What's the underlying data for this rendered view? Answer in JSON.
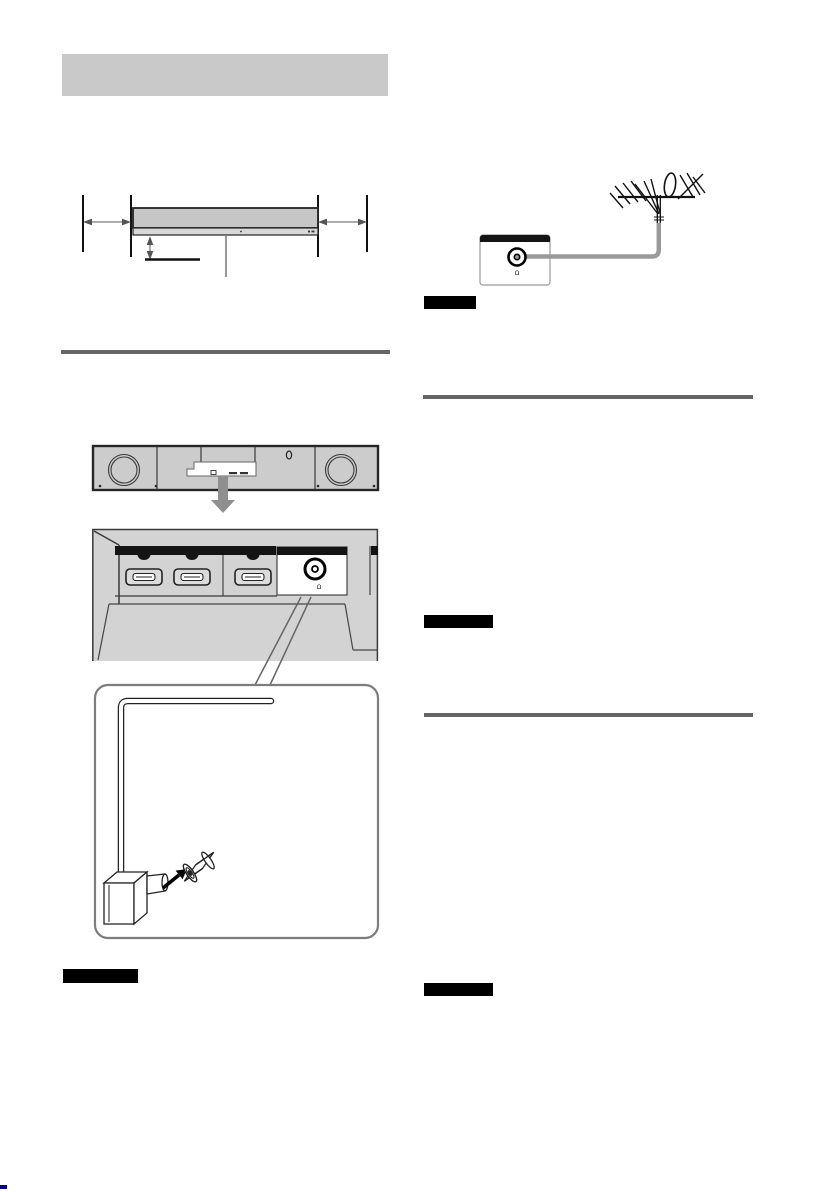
{
  "page": {
    "type": "instruction-manual-page",
    "colors": {
      "page_bg": "#ffffff",
      "section_title_bg": "#c9c9c9",
      "rule": "#666666",
      "badge_bg": "#000000",
      "line_art": "#222222",
      "device_gray": "#cccccc",
      "panel_gray": "#d3d3d3",
      "strip_black": "#141414",
      "cable_gray": "#9a9a9a",
      "arrow_gray": "#8f8f8f",
      "corner_mark": "#00007f"
    }
  },
  "left_column": {
    "section_title_text": "",
    "clearance_diagram": {
      "description_icons": [
        "left-clearance-arrow-icon",
        "right-clearance-arrow-icon",
        "height-clearance-arrow-icon",
        "callout-line"
      ]
    },
    "rear_view": {
      "icons": [
        "woofer-circle-icon",
        "connector-bay-inset",
        "wall-mount-keyhole-icon",
        "zoom-down-arrow-icon"
      ]
    },
    "connector_panel": {
      "ports": [
        "hdmi-port",
        "hdmi-port",
        "hdmi-port",
        "antenna-coax-jack"
      ],
      "antenna_jack_symbol": "Ω"
    },
    "cable_detail": {
      "icons": [
        "antenna-cable",
        "right-angle-plug-icon",
        "insert-arrow-icon",
        "coax-adapter-icon"
      ]
    },
    "note_badge_text": ""
  },
  "right_column": {
    "antenna_connection": {
      "icons": [
        "tv-aerial-icon",
        "antenna-cable",
        "antenna-wall-jack-icon"
      ],
      "antenna_jack_symbol": "Ω"
    },
    "note_badge_1_text": "",
    "note_badge_2_text": "",
    "note_badge_3_text": ""
  }
}
